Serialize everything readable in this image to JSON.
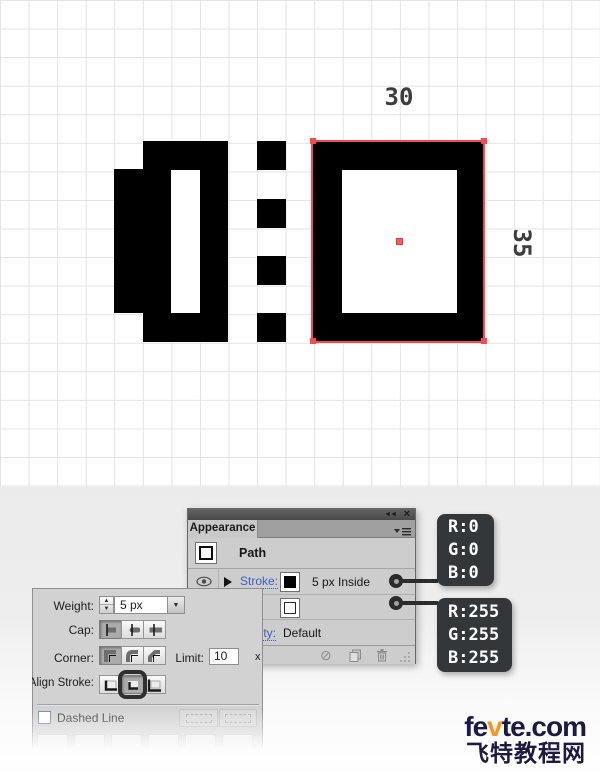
{
  "canvas": {
    "width_label": "30",
    "height_label": "35",
    "selection_red": "#f74b4b"
  },
  "appearance_panel": {
    "tab_title": "Appearance",
    "collapse_icon": "◄◄",
    "close_icon": "×",
    "rows": {
      "path": {
        "label": "Path"
      },
      "stroke": {
        "link": "Stroke:",
        "weight": "5 px",
        "align": "Inside"
      },
      "opacity": {
        "link": "Opacity:",
        "value": "Default"
      }
    },
    "icons": {
      "expand_triangle": "▶",
      "no_style": "⊘"
    }
  },
  "stroke_panel": {
    "weight_label": "Weight:",
    "weight_value": "5 px",
    "stepper_up": "▲",
    "stepper_down": "▼",
    "dropdown_arrow": "▼",
    "cap_label": "Cap:",
    "corner_label": "Corner:",
    "limit_label": "Limit:",
    "limit_value": "10",
    "limit_unit": "x",
    "align_label": "Align Stroke:",
    "dashed_label": "Dashed Line"
  },
  "callouts": {
    "bg_color": "#34373a",
    "black": {
      "lines": [
        "R:0",
        "G:0",
        "B:0"
      ]
    },
    "white": {
      "lines": [
        "R:255",
        "G:255",
        "B:255"
      ]
    }
  },
  "watermark": {
    "en_part1": "fe",
    "en_accent": "v",
    "en_part2": "te.com",
    "cn": "飞特教程网",
    "navy": "#1a1a44",
    "orange": "#f7941e"
  }
}
